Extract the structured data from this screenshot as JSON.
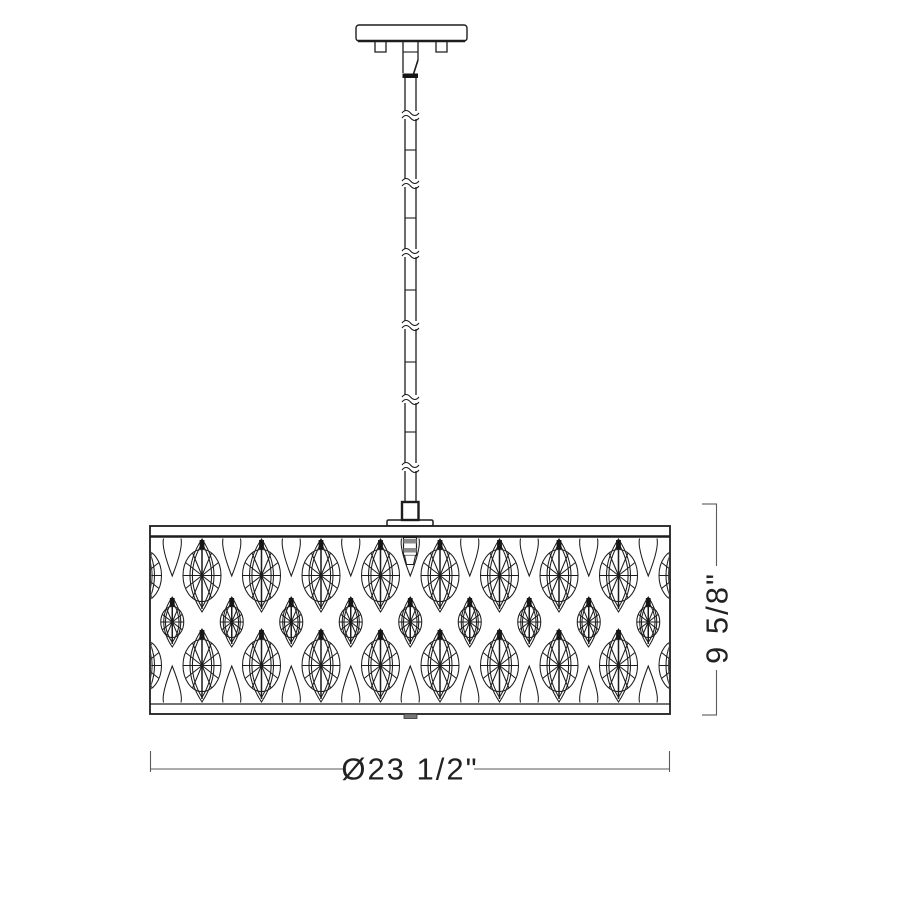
{
  "diagram": {
    "kind": "pendant-light-dimension-drawing",
    "dimensions": {
      "diameter_label": "Ø23 1/2\"",
      "height_label": "9 5/8\""
    },
    "colors": {
      "line": "#1d1d1d",
      "dimension_line": "#5a5a5a",
      "text": "#222222",
      "background": "#ffffff"
    }
  }
}
